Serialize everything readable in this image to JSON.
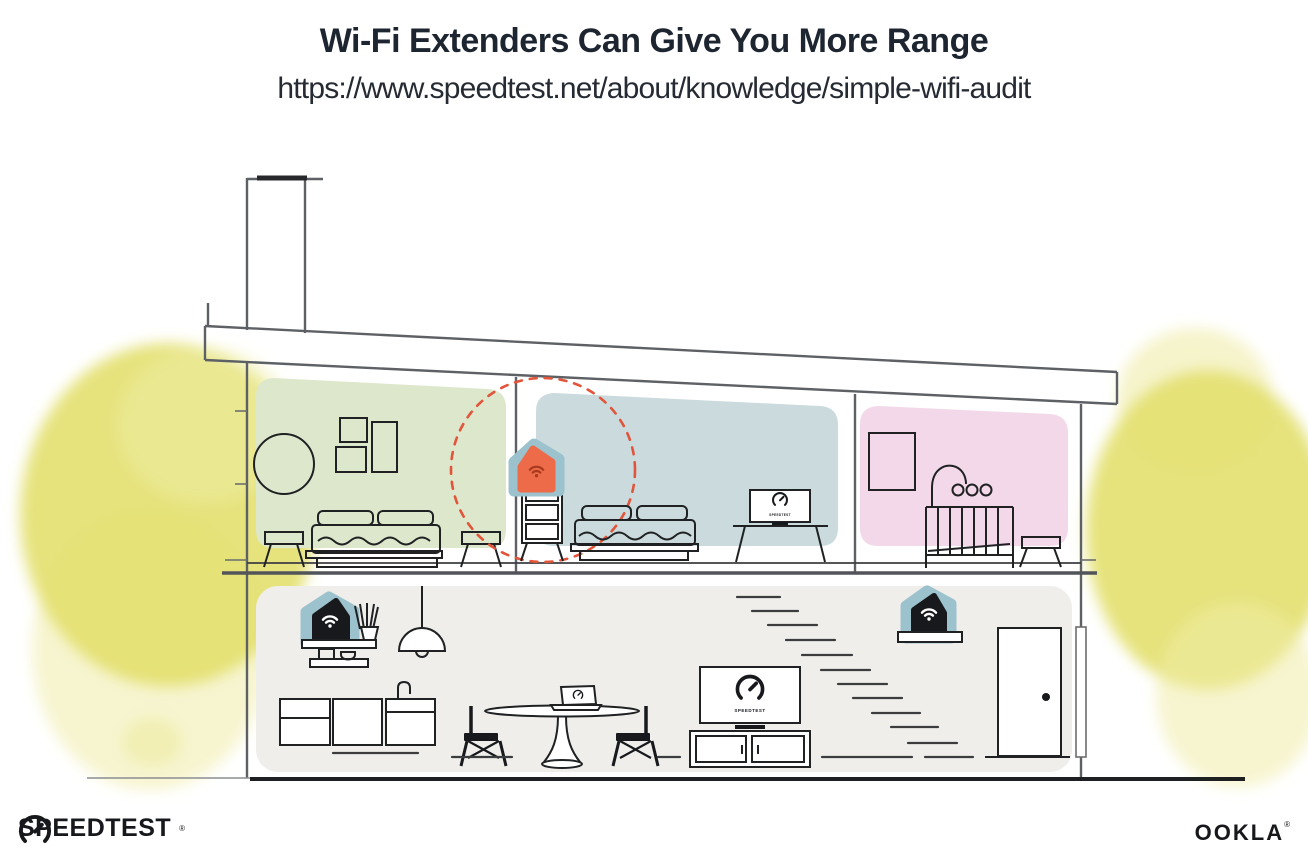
{
  "header": {
    "title": "Wi-Fi Extenders Can Give You More Range",
    "url": "https://www.speedtest.net/about/knowledge/simple-wifi-audit"
  },
  "brand": {
    "screen_label": "SPEEDTEST"
  },
  "footer": {
    "speedtest_wordmark": "SPEEDTEST",
    "speedtest_reg": "®",
    "ookla_wordmark": "OOKLA",
    "ookla_reg": "®"
  },
  "icons": {
    "wifi_icon": "wifi signal arcs with dot",
    "gauge_icon": "speedometer dial with needle",
    "door_knob_icon": "black dot"
  },
  "colors": {
    "title_text": "#1d2530",
    "subtitle_text": "#262b33",
    "room_green": "#dde7cb",
    "room_blue": "#cadadd",
    "room_pink": "#f3d8e9",
    "ground_gray": "#efeeeb",
    "foliage": "#e3e06e",
    "foliage_light": "#f0eda8",
    "extender_teal": "#9cc2cd",
    "extender_orange": "#ed6b49",
    "wifi_red": "#aa3a1d",
    "device_black": "#17191d",
    "signal_red": "#e2553a",
    "wall_line": "#5d6165",
    "furniture_line": "#1f2123",
    "logo_text": "#16181b"
  }
}
